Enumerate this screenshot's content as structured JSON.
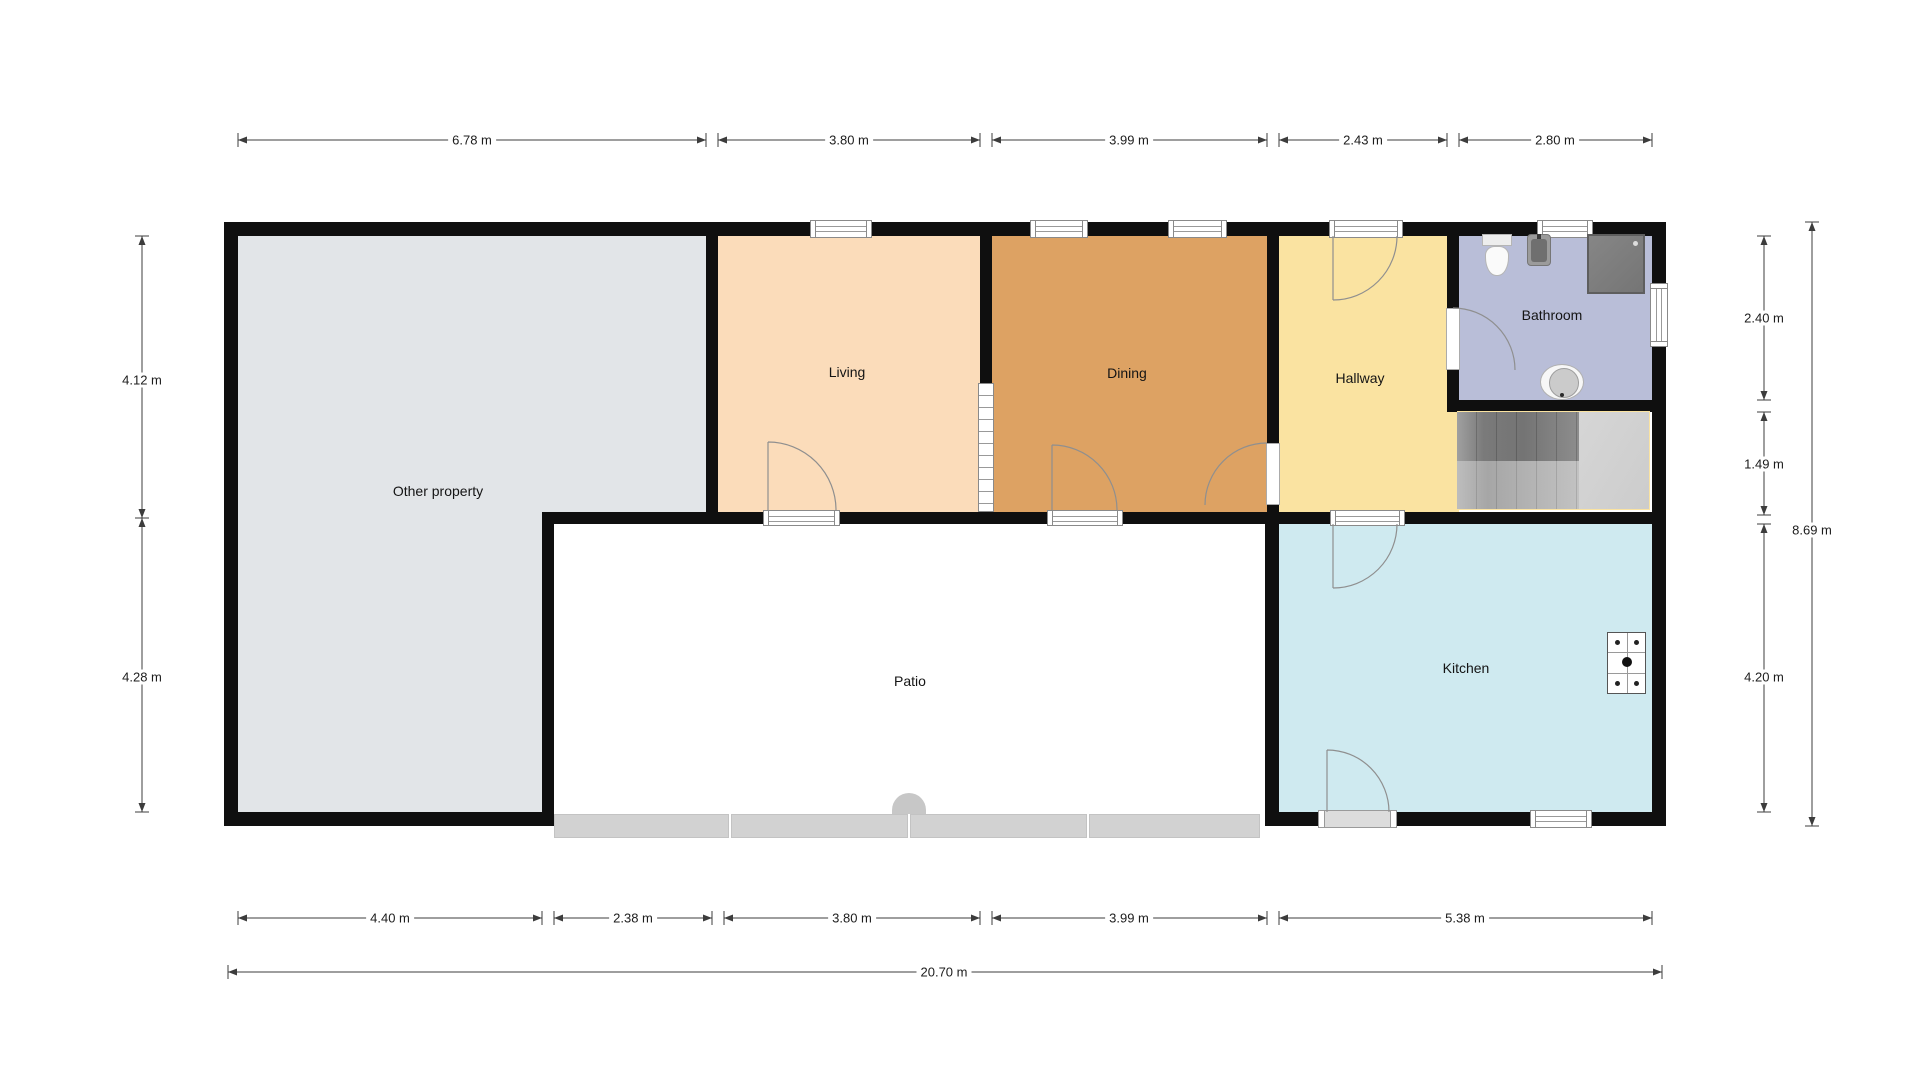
{
  "plan_title": "Floor plan",
  "rooms": {
    "other_property": {
      "label": "Other property",
      "color": "#e2e5e8"
    },
    "living": {
      "label": "Living",
      "color": "#fbdcba"
    },
    "dining": {
      "label": "Dining",
      "color": "#dda263"
    },
    "hallway": {
      "label": "Hallway",
      "color": "#fae3a1"
    },
    "bathroom": {
      "label": "Bathroom",
      "color": "#b9bed8"
    },
    "kitchen": {
      "label": "Kitchen",
      "color": "#cfeaf0"
    },
    "patio": {
      "label": "Patio",
      "color": "#ffffff"
    }
  },
  "dimensions": {
    "top": [
      "6.78 m",
      "3.80 m",
      "3.99 m",
      "2.43 m",
      "2.80 m"
    ],
    "bottom": [
      "4.40 m",
      "2.38 m",
      "3.80 m",
      "3.99 m",
      "5.38 m"
    ],
    "total_width": "20.70 m",
    "left": [
      "4.12 m",
      "4.28 m"
    ],
    "right": [
      "2.40 m",
      "1.49 m",
      "4.20 m"
    ],
    "right_total": "8.69 m"
  },
  "colors": {
    "wall": "#0f0f0f",
    "dimension": "#3c3c3c",
    "door_arc": "#8f8f8f",
    "fence": "#d2d2d2",
    "stairs_landing": "#d2d2d2"
  }
}
